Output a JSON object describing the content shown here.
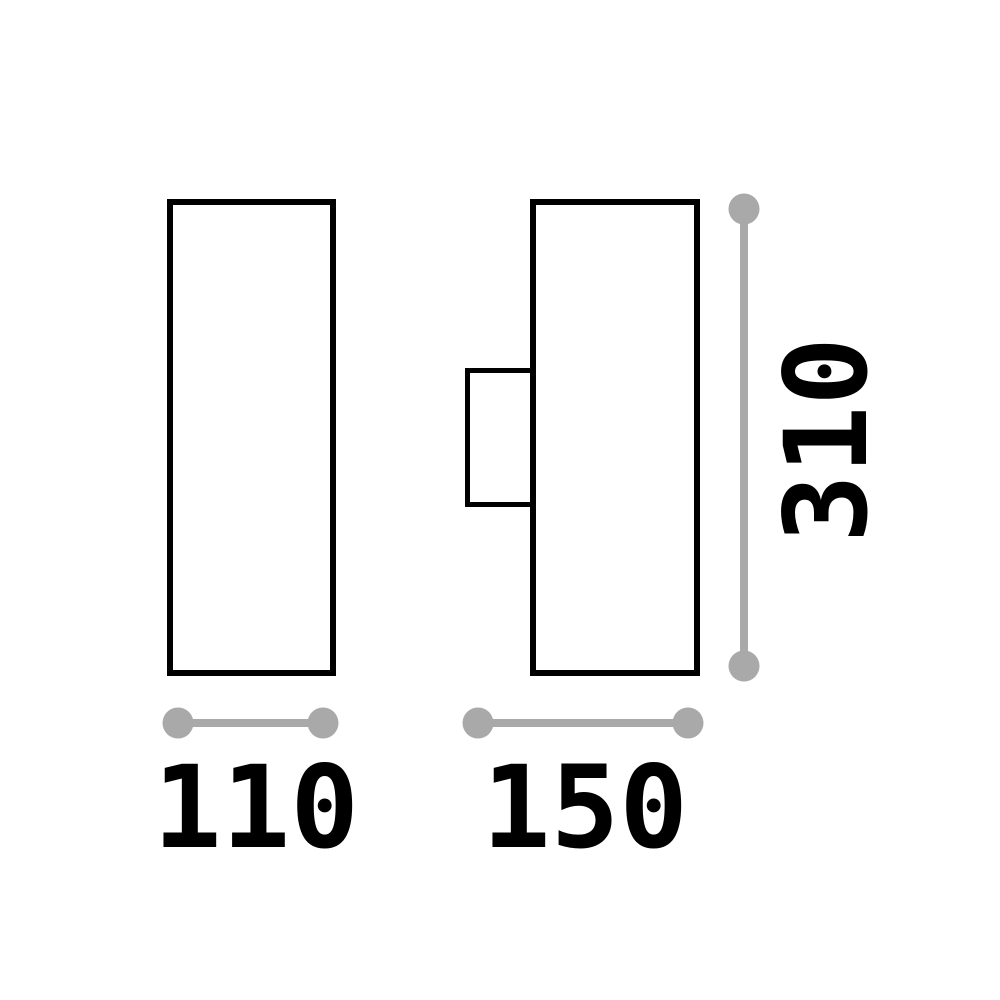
{
  "colors": {
    "outline": "#000000",
    "dimension": "#a9a9a9",
    "background": "#ffffff"
  },
  "dimensions": {
    "front_width": "110",
    "side_depth": "150",
    "height": "310"
  }
}
